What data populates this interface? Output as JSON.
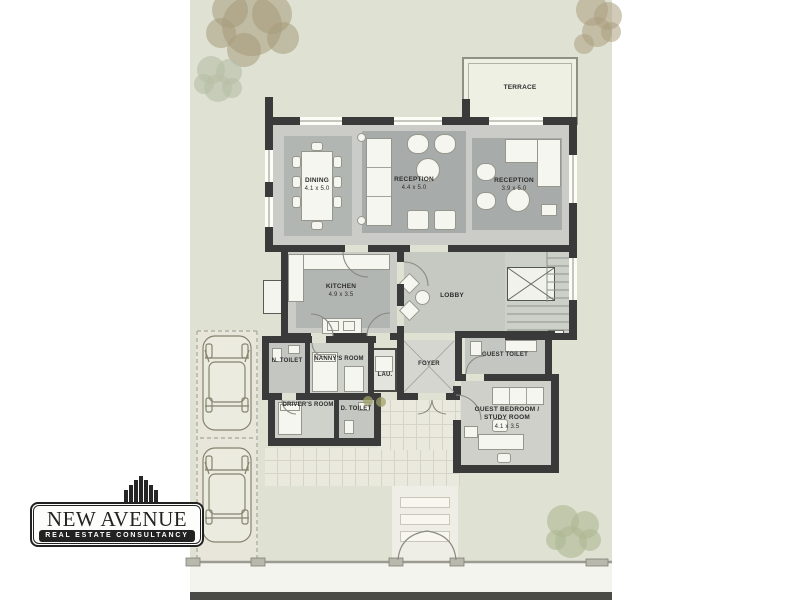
{
  "brand": {
    "name": "NEW AVENUE",
    "tagline": "REAL ESTATE CONSULTANCY"
  },
  "plan": {
    "rooms": [
      {
        "name": "TERRACE",
        "dims": ""
      },
      {
        "name": "DINING",
        "dims": "4.1 x 5.0"
      },
      {
        "name": "RECEPTION",
        "dims": "4.4 x 5.0"
      },
      {
        "name": "RECEPTION",
        "dims": "3.9 x 5.0"
      },
      {
        "name": "KITCHEN",
        "dims": "4.9 x 3.5"
      },
      {
        "name": "LOBBY",
        "dims": ""
      },
      {
        "name": "N. TOILET",
        "dims": ""
      },
      {
        "name": "NANNY'S ROOM",
        "dims": ""
      },
      {
        "name": "LAU.",
        "dims": ""
      },
      {
        "name": "FOYER",
        "dims": ""
      },
      {
        "name": "GUEST TOILET",
        "dims": ""
      },
      {
        "name": "DRIVER'S ROOM",
        "dims": ""
      },
      {
        "name": "D. TOILET",
        "dims": ""
      },
      {
        "name": "GUEST BEDROOM / STUDY ROOM",
        "dims": "4.1 x 3.5"
      }
    ]
  },
  "colors": {
    "site_green": "#dfe2d3",
    "wall": "#3a3a3a",
    "floor": "#cbccc7",
    "rug": "#b2b6b2",
    "rug_dark": "#a7acaa",
    "furniture": "#f6f6f1",
    "terrace": "#eef0e4",
    "driveway": "#e8e6da",
    "paving": "#eae9dd",
    "street": "#4a4a47",
    "label": "#2e2e2e",
    "ink": "#222222",
    "tree_brown": "#a59a7c",
    "tree_green": "#b4bca3"
  }
}
